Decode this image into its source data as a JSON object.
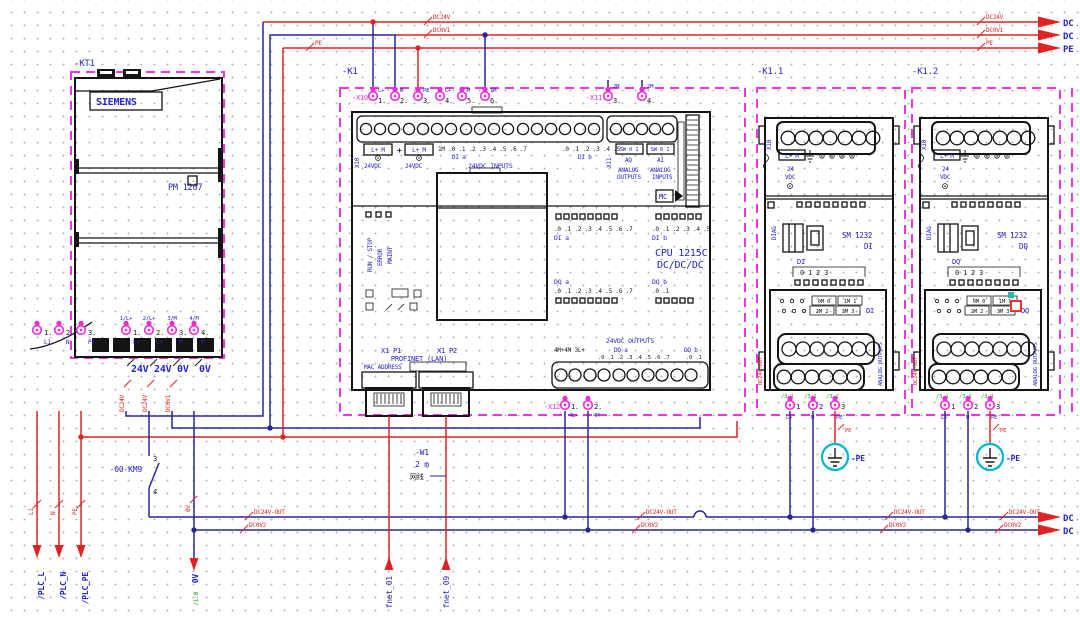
{
  "colors": {
    "wire_red": "#e02222",
    "wire_blue": "#27279a",
    "magenta_border": "#f233e0",
    "label_blue": "#2424c8",
    "green_ref": "#1fa01f",
    "pe_cyan": "#00b6d2"
  },
  "rails_top": {
    "r1": {
      "name": "DC24V",
      "arrow": "DC"
    },
    "r2": {
      "name": "DC0V1",
      "arrow": "DC"
    },
    "r3": {
      "name": "PE",
      "arrow": "PE"
    }
  },
  "rails_bottom": {
    "r1": {
      "name": "DC24V-OUT",
      "arrow": "DC"
    },
    "r2": {
      "name": "DC0V2",
      "arrow": "DC"
    }
  },
  "psu": {
    "tag": "-KT1",
    "brand": "SIEMENS",
    "model": "PM 1207",
    "in_terms": [
      {
        "n": "1.",
        "label": "L1"
      },
      {
        "n": "2.",
        "label": "N"
      },
      {
        "n": "3.",
        "label": "PE"
      }
    ],
    "in_wire_names": [
      "L1",
      "N",
      "PE"
    ],
    "in_arrows": [
      "/PLC_L",
      "/PLC_N",
      "/PLC_PE"
    ],
    "out_refs": [
      "1/L+",
      "2/L+",
      "3/M",
      "4/M"
    ],
    "out_terms": [
      {
        "n": "1.",
        "label": "L+"
      },
      {
        "n": "2.",
        "label": "L+"
      },
      {
        "n": "3.",
        "label": "M"
      },
      {
        "n": "4.",
        "label": "M"
      }
    ],
    "out_wire_labels": [
      "24V",
      "24V",
      "0V",
      "0V"
    ],
    "out_wire_names": [
      "DC24V",
      "DC24V",
      "DC0V1"
    ]
  },
  "km9": {
    "tag": "-00-KM9",
    "c1": "3",
    "c2": "4"
  },
  "v0": {
    "wire": "0V",
    "label": "0V",
    "ref": "/1.0"
  },
  "cpu": {
    "tag": "-K1",
    "x10": {
      "tag": "-X10",
      "terms": [
        {
          "n": "1.",
          "label": "L+"
        },
        {
          "n": "2.",
          "label": "M"
        },
        {
          "n": "3.",
          "label": "PE"
        },
        {
          "n": "4.",
          "label": "L+"
        },
        {
          "n": "5.",
          "label": "M"
        },
        {
          "n": "6.",
          "label": "1M"
        }
      ]
    },
    "x11": {
      "tag": "-X11",
      "terms": [
        {
          "n": "3.",
          "label": "2M"
        },
        {
          "n": "4.",
          "label": "2M"
        }
      ]
    },
    "x12": {
      "tag": "-X12",
      "terms": [
        {
          "n": "1.",
          "label": "4L+"
        },
        {
          "n": "2.",
          "label": "4M"
        }
      ]
    },
    "x10_vert": "X10",
    "x11_vert": "X11",
    "ps1_pins": "L+ M",
    "ps1_v": "24VDC",
    "ps2_pins": "L+ M",
    "ps2_v": "24VDC",
    "di_nums_a": "1M .0 .1 .2 .3 .4 .5 .6 .7",
    "di_nums_b": ".0 .1 .2 .3 .4 .5",
    "di_a": "DI a",
    "di_b": "DI b",
    "inputs_title": "24VDC INPUTS",
    "sw1": "SW 0 1",
    "aq": "AQ",
    "an_out1": "ANALOG",
    "an_out2": "OUTPUTS",
    "sw2": "SW 0 1",
    "ai": "AI",
    "an_in1": "ANALOG",
    "an_in2": "INPUTS",
    "led_run": "RUN / STOP",
    "led_err": "ERROR",
    "led_maint": "MAINT",
    "mc": "MC",
    "st_di_a_nums": ".0 .1 .2 .3 .4 .5 .6 .7",
    "st_di_a": "DI a",
    "st_di_b_nums": ".0 .1 .2 .3 .4 .5",
    "st_di_b": "DI b",
    "name1": "CPU 1215C",
    "name2": "DC/DC/DC",
    "st_dq_a": "DQ a",
    "st_dq_a_nums": ".0 .1 .2 .3 .4 .5 .6 .7",
    "st_dq_b": "DQ b",
    "st_dq_b_nums": ".0 .1",
    "p1": "X1 P1",
    "p2": "X1 P2",
    "profinet": "PROFINET (LAN)",
    "mac": "MAC ADDRESS",
    "outputs_title": "24VDC OUTPUTS",
    "out_left": "4M+4M 3L+",
    "out_dq_a": "DQ a",
    "out_dq_a_nums": ".0 .1 .2 .3 .4 .5 .6 .7",
    "out_dq_b": "DQ b",
    "out_dq_b_nums": ".0 .1"
  },
  "cable": {
    "tag": "-W1",
    "length": "2 m",
    "type": "网线"
  },
  "fnet": [
    "fnet_01",
    "fnet_09"
  ],
  "modules": [
    {
      "tag": "-K1.1",
      "x10_vert": "X10",
      "pins": "L+ M",
      "v1": "24",
      "v2": "VDC",
      "diag": "DIAG",
      "model": "SM 1232",
      "type": "DI",
      "ch": "DI",
      "ch_nums": "0 1 2 3",
      "t1": "0M 0",
      "t2": "1M 1",
      "t3": "2M 2",
      "t4": "3M 3",
      "group": "DI",
      "side": "ANALOG OUTPUTS",
      "wire_name": "DC24V-OUT",
      "refs": [
        "/3.1",
        "/3.1",
        "/3.1"
      ],
      "terms": [
        {
          "n": "1",
          "label": "L+"
        },
        {
          "n": "2",
          "label": "M"
        },
        {
          "n": "3",
          "label": "PE"
        }
      ],
      "pe_wire": "PE",
      "pe": "-PE"
    },
    {
      "tag": "-K1.2",
      "x10_vert": "X10",
      "pins": "L+ M",
      "v1": "24",
      "v2": "VDC",
      "diag": "DIAG",
      "model": "SM 1232",
      "type": "DQ",
      "ch": "DQ",
      "ch_nums": "0 1 2 3",
      "t1": "0M 0",
      "t2": "1M 1",
      "t3": "2M 2",
      "t4": "3M 3",
      "group": "DQ",
      "side": "ANALOG OUTPUTS",
      "wire_name": "DC24V-OUT",
      "refs": [
        "/3.1",
        "/3.1",
        "/3.1"
      ],
      "terms": [
        {
          "n": "1",
          "label": "L+"
        },
        {
          "n": "2",
          "label": "M"
        },
        {
          "n": "3",
          "label": "PE"
        }
      ],
      "pe_wire": "PE",
      "pe": "-PE"
    }
  ]
}
